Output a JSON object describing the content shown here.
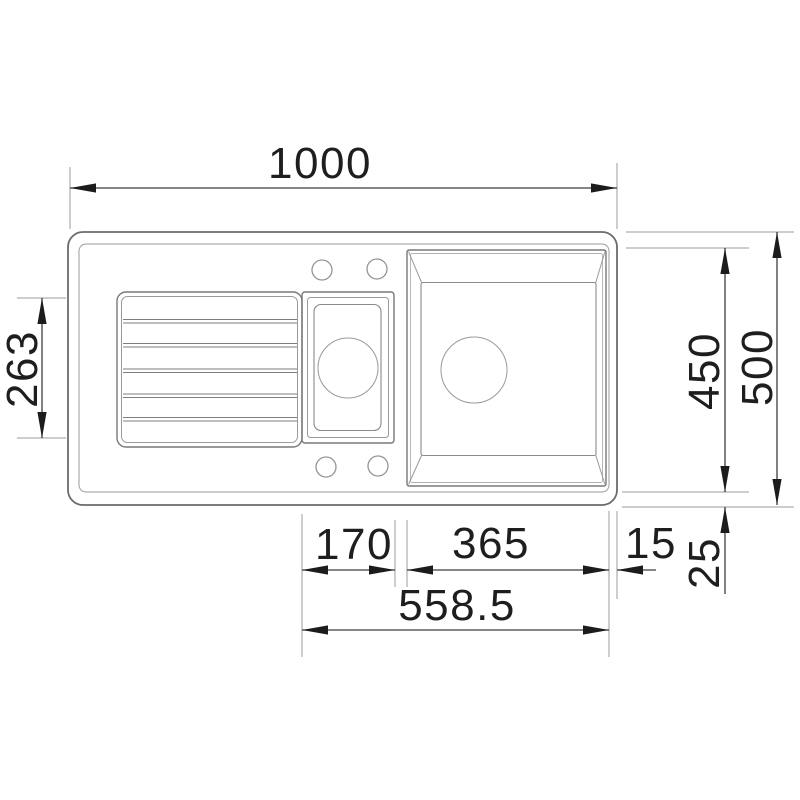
{
  "drawing": {
    "background": "#ffffff",
    "line_color": "#787878",
    "dimension_color": "#3d3d3d",
    "text_color": "#1e1e1e",
    "labels": {
      "overall_width": "1000",
      "drainboard_depth": "263",
      "basin_depth": "450",
      "overall_depth": "500",
      "small_bowl_width": "170",
      "large_bowl_width": "365",
      "right_edge": "15",
      "rim_width": "25",
      "bowls_span": "558.5"
    }
  }
}
